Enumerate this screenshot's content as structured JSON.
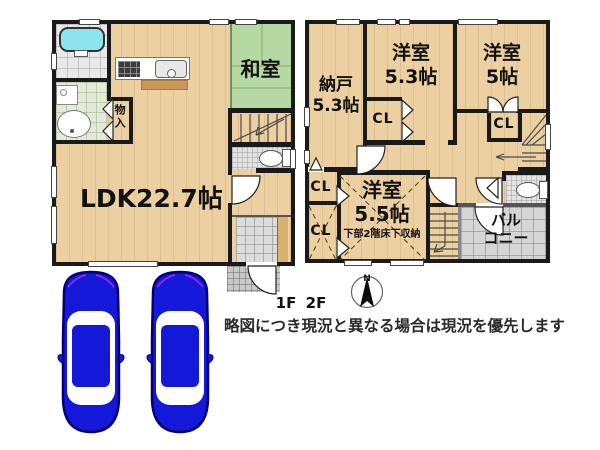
{
  "floor1": {
    "label": "1F",
    "ldk_label": "LDK22.7帖",
    "washitsu_label": "和室",
    "storage_label": "物入"
  },
  "floor2": {
    "label": "2F",
    "nando_name": "納戸",
    "nando_size": "5.3帖",
    "west_a_name": "洋室",
    "west_a_size": "5.3帖",
    "west_b_name": "洋室",
    "west_b_size": "5帖",
    "west_c_name": "洋室",
    "west_c_size": "5.5帖",
    "west_c_note": "下部2階床下収納",
    "cl_label": "CL",
    "balcony_line1": "バル",
    "balcony_line2": "コニー"
  },
  "compass": {
    "north_label": "N"
  },
  "footer": {
    "disclaimer": "略図につき現況と異なる場合は現況を優先します"
  },
  "colors": {
    "wall": "#1a1a1a",
    "wood_floor": "#ecd0a2",
    "tatami_green": "#b6d8a2",
    "bathtub_cyan": "#8de4ee",
    "car_body_blue": "#1418d8",
    "car_outline": "#000070",
    "tile_gray": "#dcdcdc"
  }
}
